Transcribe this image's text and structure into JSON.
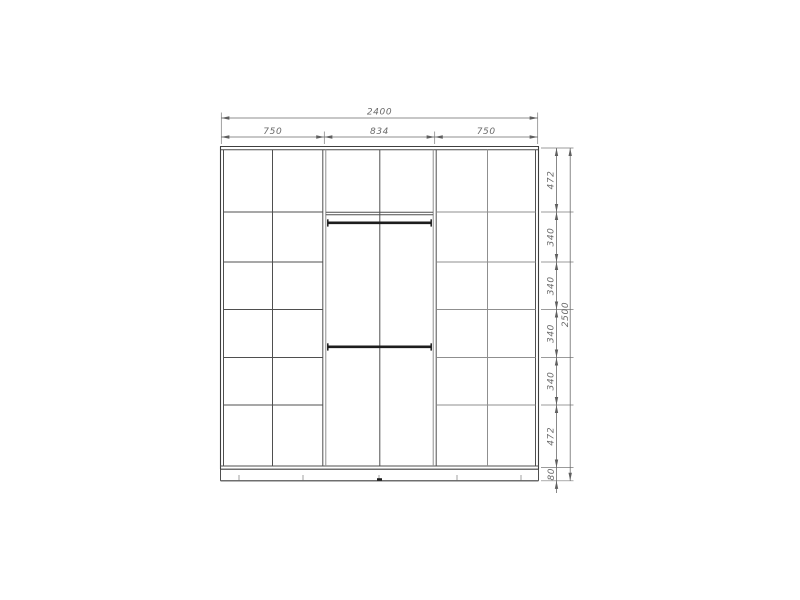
{
  "drawing": {
    "kind": "wardrobe-front-elevation-technical-drawing",
    "background_color": "#ffffff",
    "line_color": "#4f4f4f",
    "dimension_color": "#6a6a6a",
    "rod_color": "#1d1d1d",
    "dimensions_top": {
      "total": "2400",
      "sections": [
        "750",
        "834",
        "750"
      ]
    },
    "dimensions_right": {
      "segments": [
        "472",
        "340",
        "340",
        "340",
        "340",
        "472"
      ],
      "plinth": "80",
      "total": "2500"
    }
  }
}
